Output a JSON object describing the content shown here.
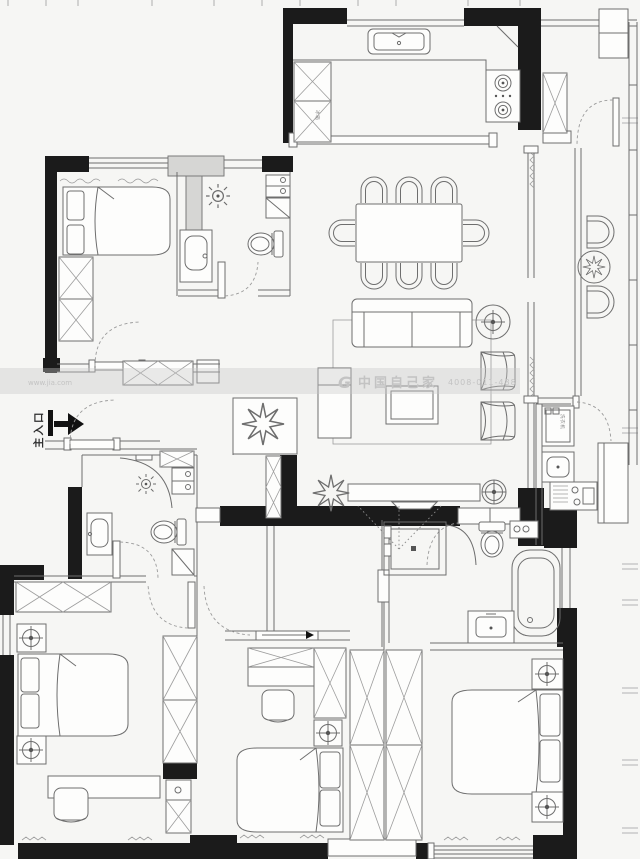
{
  "plan": {
    "type": "apartment-floor-plan",
    "colors": {
      "wall": "#1b1b1b",
      "line": "#6e6e6e",
      "light_line": "#9d9d9d",
      "background": "#f6f6f4",
      "watermark": "#c3c3c3"
    }
  },
  "labels": {
    "main_entrance": "主入口",
    "washing_machine": "洗衣机",
    "fridge": "冰箱"
  },
  "watermark": {
    "site": "www.jia.com",
    "logo": "G",
    "brand": "中国自己家",
    "phone": "4008-011-488"
  }
}
